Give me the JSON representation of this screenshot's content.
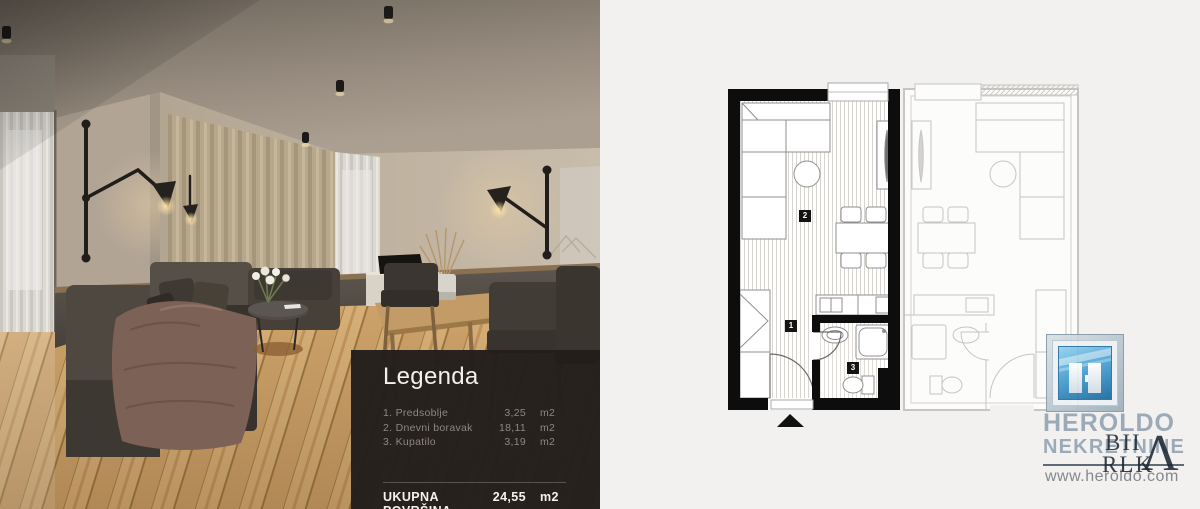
{
  "legend": {
    "title": "Legenda",
    "items": [
      {
        "label": "1. Predsoblje",
        "value": "3,25",
        "unit": "m2"
      },
      {
        "label": "2. Dnevni boravak",
        "value": "18,11",
        "unit": "m2"
      },
      {
        "label": "3. Kupatilo",
        "value": "3,19",
        "unit": "m2"
      }
    ],
    "total_label": "UKUPNA POVRŠINA",
    "total_value": "24,55",
    "total_unit": "m2"
  },
  "plan": {
    "room_numbers": {
      "hall": "1",
      "living": "2",
      "bath": "3"
    }
  },
  "logo": {
    "name_line1": "HEROLDO",
    "name_line2": "NEKRETNINE",
    "website": "www.heroldo.com"
  },
  "watermark": {
    "line1": "BII",
    "line2": "RLK",
    "accent": "Λ"
  },
  "colors": {
    "legend_bg": "#221e1c",
    "logo_text": "#93a3b3",
    "logo_icon_blue": "#2f85bd",
    "plan_wall": "#0d0d0d",
    "right_background": "#f2f1ef"
  }
}
